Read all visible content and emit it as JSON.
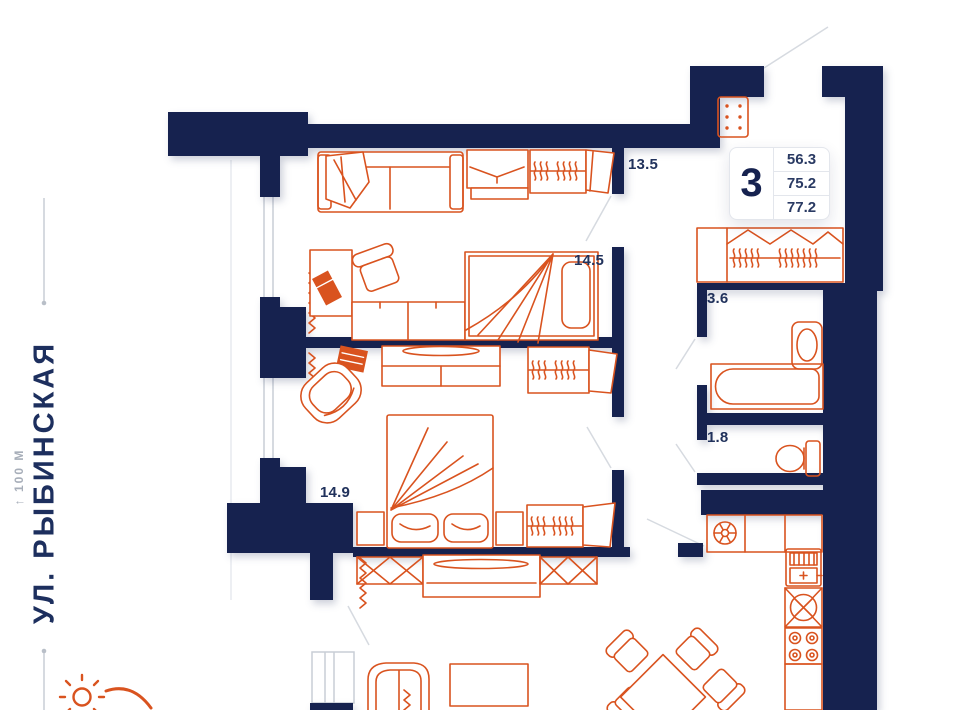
{
  "theme": {
    "wall_color": "#16224f",
    "furniture_color": "#d9531f",
    "label_color": "#21325c",
    "muted_text_color": "#a7aeb9",
    "guide_line_color": "#c9ced6",
    "door_line_color": "#d6dae0",
    "badge_border": "#e3e6ec",
    "background": "#ffffff"
  },
  "street": {
    "name": "УЛ. РЫБИНСКАЯ",
    "distance_marker": "↑ 100 М"
  },
  "info_badge": {
    "rooms": "3",
    "areas": [
      "56.3",
      "75.2",
      "77.2"
    ]
  },
  "rooms": [
    {
      "id": "bedroom-1",
      "label": "13.5"
    },
    {
      "id": "bedroom-2",
      "label": "14.5"
    },
    {
      "id": "bedroom-3",
      "label": "14.9"
    },
    {
      "id": "bathroom",
      "label": "3.6"
    },
    {
      "id": "toilet",
      "label": "1.8"
    }
  ],
  "icons": [
    "sun-icon",
    "sofa-icon",
    "wardrobe-icon",
    "dresser-icon",
    "desk-icon",
    "laptop-icon",
    "office-chair-icon",
    "single-bed-icon",
    "double-bed-icon",
    "nightstand-icon",
    "corner-chair-icon",
    "tv-icon",
    "shoe-cabinet-icon",
    "bathtub-icon",
    "washbasin-icon",
    "toilet-icon",
    "vent-icon",
    "fridge-icon",
    "kitchen-sink-icon",
    "stove-icon",
    "dining-table-icon",
    "dining-chair-icon",
    "tv-stand-icon",
    "coffee-table-icon",
    "radiator-icon",
    "window-icon",
    "door-swing-icon"
  ]
}
